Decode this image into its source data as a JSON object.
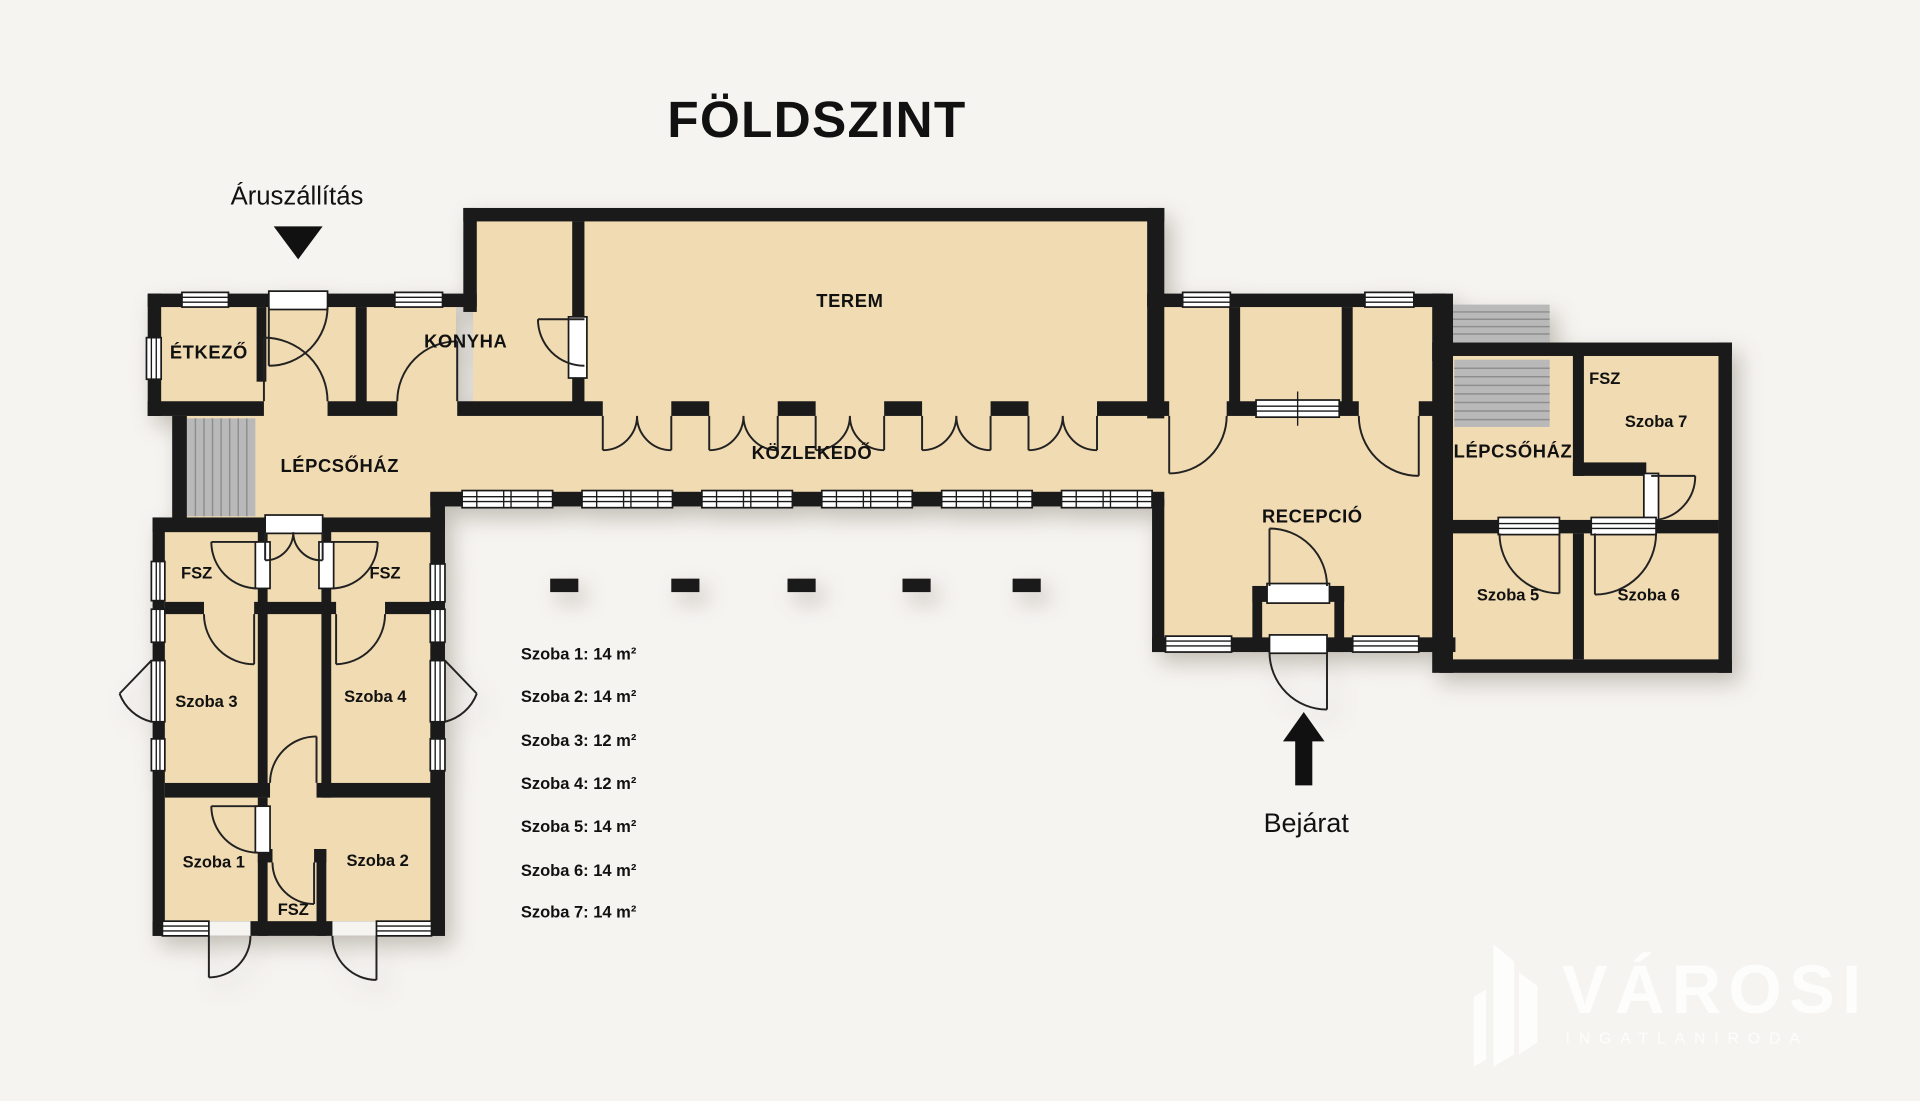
{
  "title": "FÖLDSZINT",
  "annotations": {
    "delivery": "Áruszállítás",
    "entrance": "Bejárat"
  },
  "rooms": [
    {
      "id": "etkezo",
      "label": "ÉTKEZŐ"
    },
    {
      "id": "konyha",
      "label": "KONYHA"
    },
    {
      "id": "terem",
      "label": "TEREM"
    },
    {
      "id": "kozlekedo",
      "label": "KÖZLEKEDŐ"
    },
    {
      "id": "lepcsohaz-left",
      "label": "LÉPCSŐHÁZ"
    },
    {
      "id": "recepcio",
      "label": "RECEPCIÓ"
    },
    {
      "id": "lepcsohaz-right",
      "label": "LÉPCSŐHÁZ"
    },
    {
      "id": "fsz-right-wing",
      "label": "FSZ"
    },
    {
      "id": "szoba-7",
      "label": "Szoba 7"
    },
    {
      "id": "szoba-5",
      "label": "Szoba 5"
    },
    {
      "id": "szoba-6",
      "label": "Szoba 6"
    },
    {
      "id": "fsz-left",
      "label": "FSZ"
    },
    {
      "id": "fsz-right",
      "label": "FSZ"
    },
    {
      "id": "szoba-3",
      "label": "Szoba 3"
    },
    {
      "id": "szoba-4",
      "label": "Szoba 4"
    },
    {
      "id": "szoba-1",
      "label": "Szoba 1"
    },
    {
      "id": "szoba-2",
      "label": "Szoba 2"
    },
    {
      "id": "fsz-bottom",
      "label": "FSZ"
    }
  ],
  "legend": {
    "items": [
      "Szoba 1: 14 m²",
      "Szoba 2: 14 m²",
      "Szoba 3: 12 m²",
      "Szoba 4: 12 m²",
      "Szoba 5: 14 m²",
      "Szoba 6: 14 m²",
      "Szoba 7: 14 m²"
    ]
  },
  "logo": {
    "name": "VÁROSI",
    "subtitle": "INGATLANIRODA"
  },
  "colors": {
    "background": "#f6f4f1",
    "wall": "#1a1a1a",
    "room": "#f1dbb2",
    "stairs": "#b9b9b9",
    "window": "#ffffff",
    "logo": "#fdfdfb",
    "text": "#111111"
  }
}
